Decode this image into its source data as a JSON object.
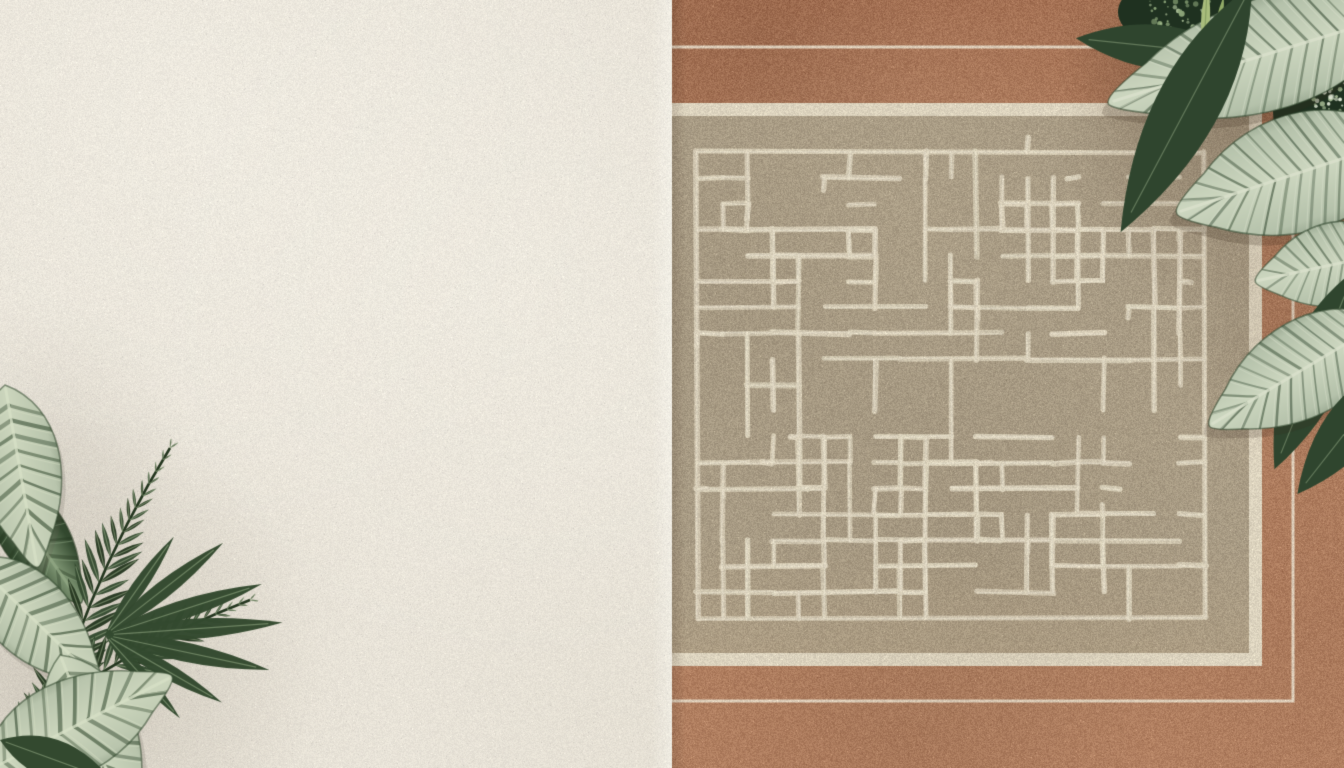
{
  "scene": {
    "description": "Top-down flat lay: cream stucco surface on the left half, a terracotta rug with cream pinstripe border, cream inner band and taupe field carved with a rectilinear maze pattern on the right half; tropical striped calathea leaves and dark palm fronds overlap from the bottom-left corner and the top-right corner",
    "noise_seed": 987654321,
    "wall": {
      "label": "stucco surface",
      "base_color": "#e9e4d9",
      "shade_color": "110,100,85"
    },
    "rug": {
      "label": "terracotta rug",
      "terracotta_top": "#a36f52",
      "terracotta_mid": "#ac7a5c",
      "terracotta_bottom": "#b28061",
      "pinstripe_color": "rgba(232,222,203,0.85)",
      "band_color": "#ddd4bf",
      "field_color": "#a89b84",
      "pattern_color": "217,208,186",
      "pattern_highlight": "238,231,212",
      "pattern_style": "rectilinear maze",
      "bands": [
        "outer terracotta border",
        "thin cream pinstripe",
        "terracotta",
        "cream band",
        "taupe field with maze pattern"
      ]
    },
    "plants": {
      "bottom_left": {
        "label": "tropical plant bottom left",
        "leaf_types": [
          "striped calathea leaves",
          "pinnate palm fronds",
          "lanceolate leaf spray"
        ],
        "colors": {
          "pale": "#b9c5ad",
          "center": "#ccd6bd",
          "mid": "#7f9674",
          "dark": "#33492f",
          "deep": "#24361f",
          "vein": "#d6dfc6"
        }
      },
      "top_right": {
        "label": "tropical plant top right",
        "leaf_types": [
          "large veined calathea leaves",
          "dark pointed leaves",
          "flower specks",
          "leaf bud"
        ],
        "colors": {
          "pale": "#b5c2ab",
          "center": "#cdd7c0",
          "mid": "#879d7b",
          "dark": "#2f452e",
          "deep": "#1f3120",
          "vein": "#d9e1cb",
          "speck1": "#dde5d2",
          "speck2": "#aabf97",
          "speck3": "#8ba478",
          "bud": "#a9bd7c",
          "bud_line": "#6f8a50"
        }
      }
    }
  }
}
